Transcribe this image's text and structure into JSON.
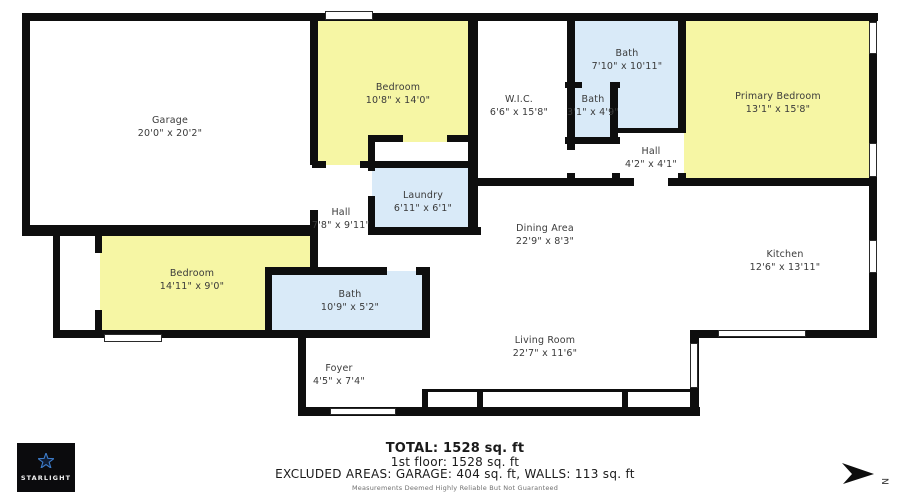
{
  "floorplan": {
    "rooms": [
      {
        "id": "garage",
        "name": "Garage",
        "dims": "20'0\" x 20'2\""
      },
      {
        "id": "bedroom-top",
        "name": "Bedroom",
        "dims": "10'8\" x 14'0\""
      },
      {
        "id": "wic",
        "name": "W.I.C.",
        "dims": "6'6\" x 15'8\""
      },
      {
        "id": "bath-top",
        "name": "Bath",
        "dims": "7'10\" x 10'11\""
      },
      {
        "id": "bath-small",
        "name": "Bath",
        "dims": "3'1\" x 4'9\""
      },
      {
        "id": "primary-bedroom",
        "name": "Primary Bedroom",
        "dims": "13'1\" x 15'8\""
      },
      {
        "id": "hall-small",
        "name": "Hall",
        "dims": "4'2\" x 4'1\""
      },
      {
        "id": "laundry",
        "name": "Laundry",
        "dims": "6'11\" x 6'1\""
      },
      {
        "id": "hall",
        "name": "Hall",
        "dims": "7'8\" x 9'11\""
      },
      {
        "id": "dining-area",
        "name": "Dining Area",
        "dims": "22'9\" x 8'3\""
      },
      {
        "id": "kitchen",
        "name": "Kitchen",
        "dims": "12'6\" x 13'11\""
      },
      {
        "id": "bedroom-left",
        "name": "Bedroom",
        "dims": "14'11\" x 9'0\""
      },
      {
        "id": "bath-mid",
        "name": "Bath",
        "dims": "10'9\" x 5'2\""
      },
      {
        "id": "living-room",
        "name": "Living Room",
        "dims": "22'7\" x 11'6\""
      },
      {
        "id": "foyer",
        "name": "Foyer",
        "dims": "4'5\" x 7'4\""
      }
    ],
    "colors": {
      "bedroom_fill": "#f6f6a4",
      "bath_fill": "#d9eaf8",
      "wall": "#0e0e0e"
    }
  },
  "summary": {
    "total": "TOTAL: 1528 sq. ft",
    "floor1": "1st floor: 1528 sq. ft",
    "excluded": "EXCLUDED AREAS: GARAGE: 404 sq. ft, WALLS: 113 sq. ft",
    "disclaimer": "Measurements Deemed Highly Reliable But Not Guaranteed"
  },
  "branding": {
    "logo_text": "STARLIGHT"
  },
  "compass": {
    "direction_label": "N"
  }
}
